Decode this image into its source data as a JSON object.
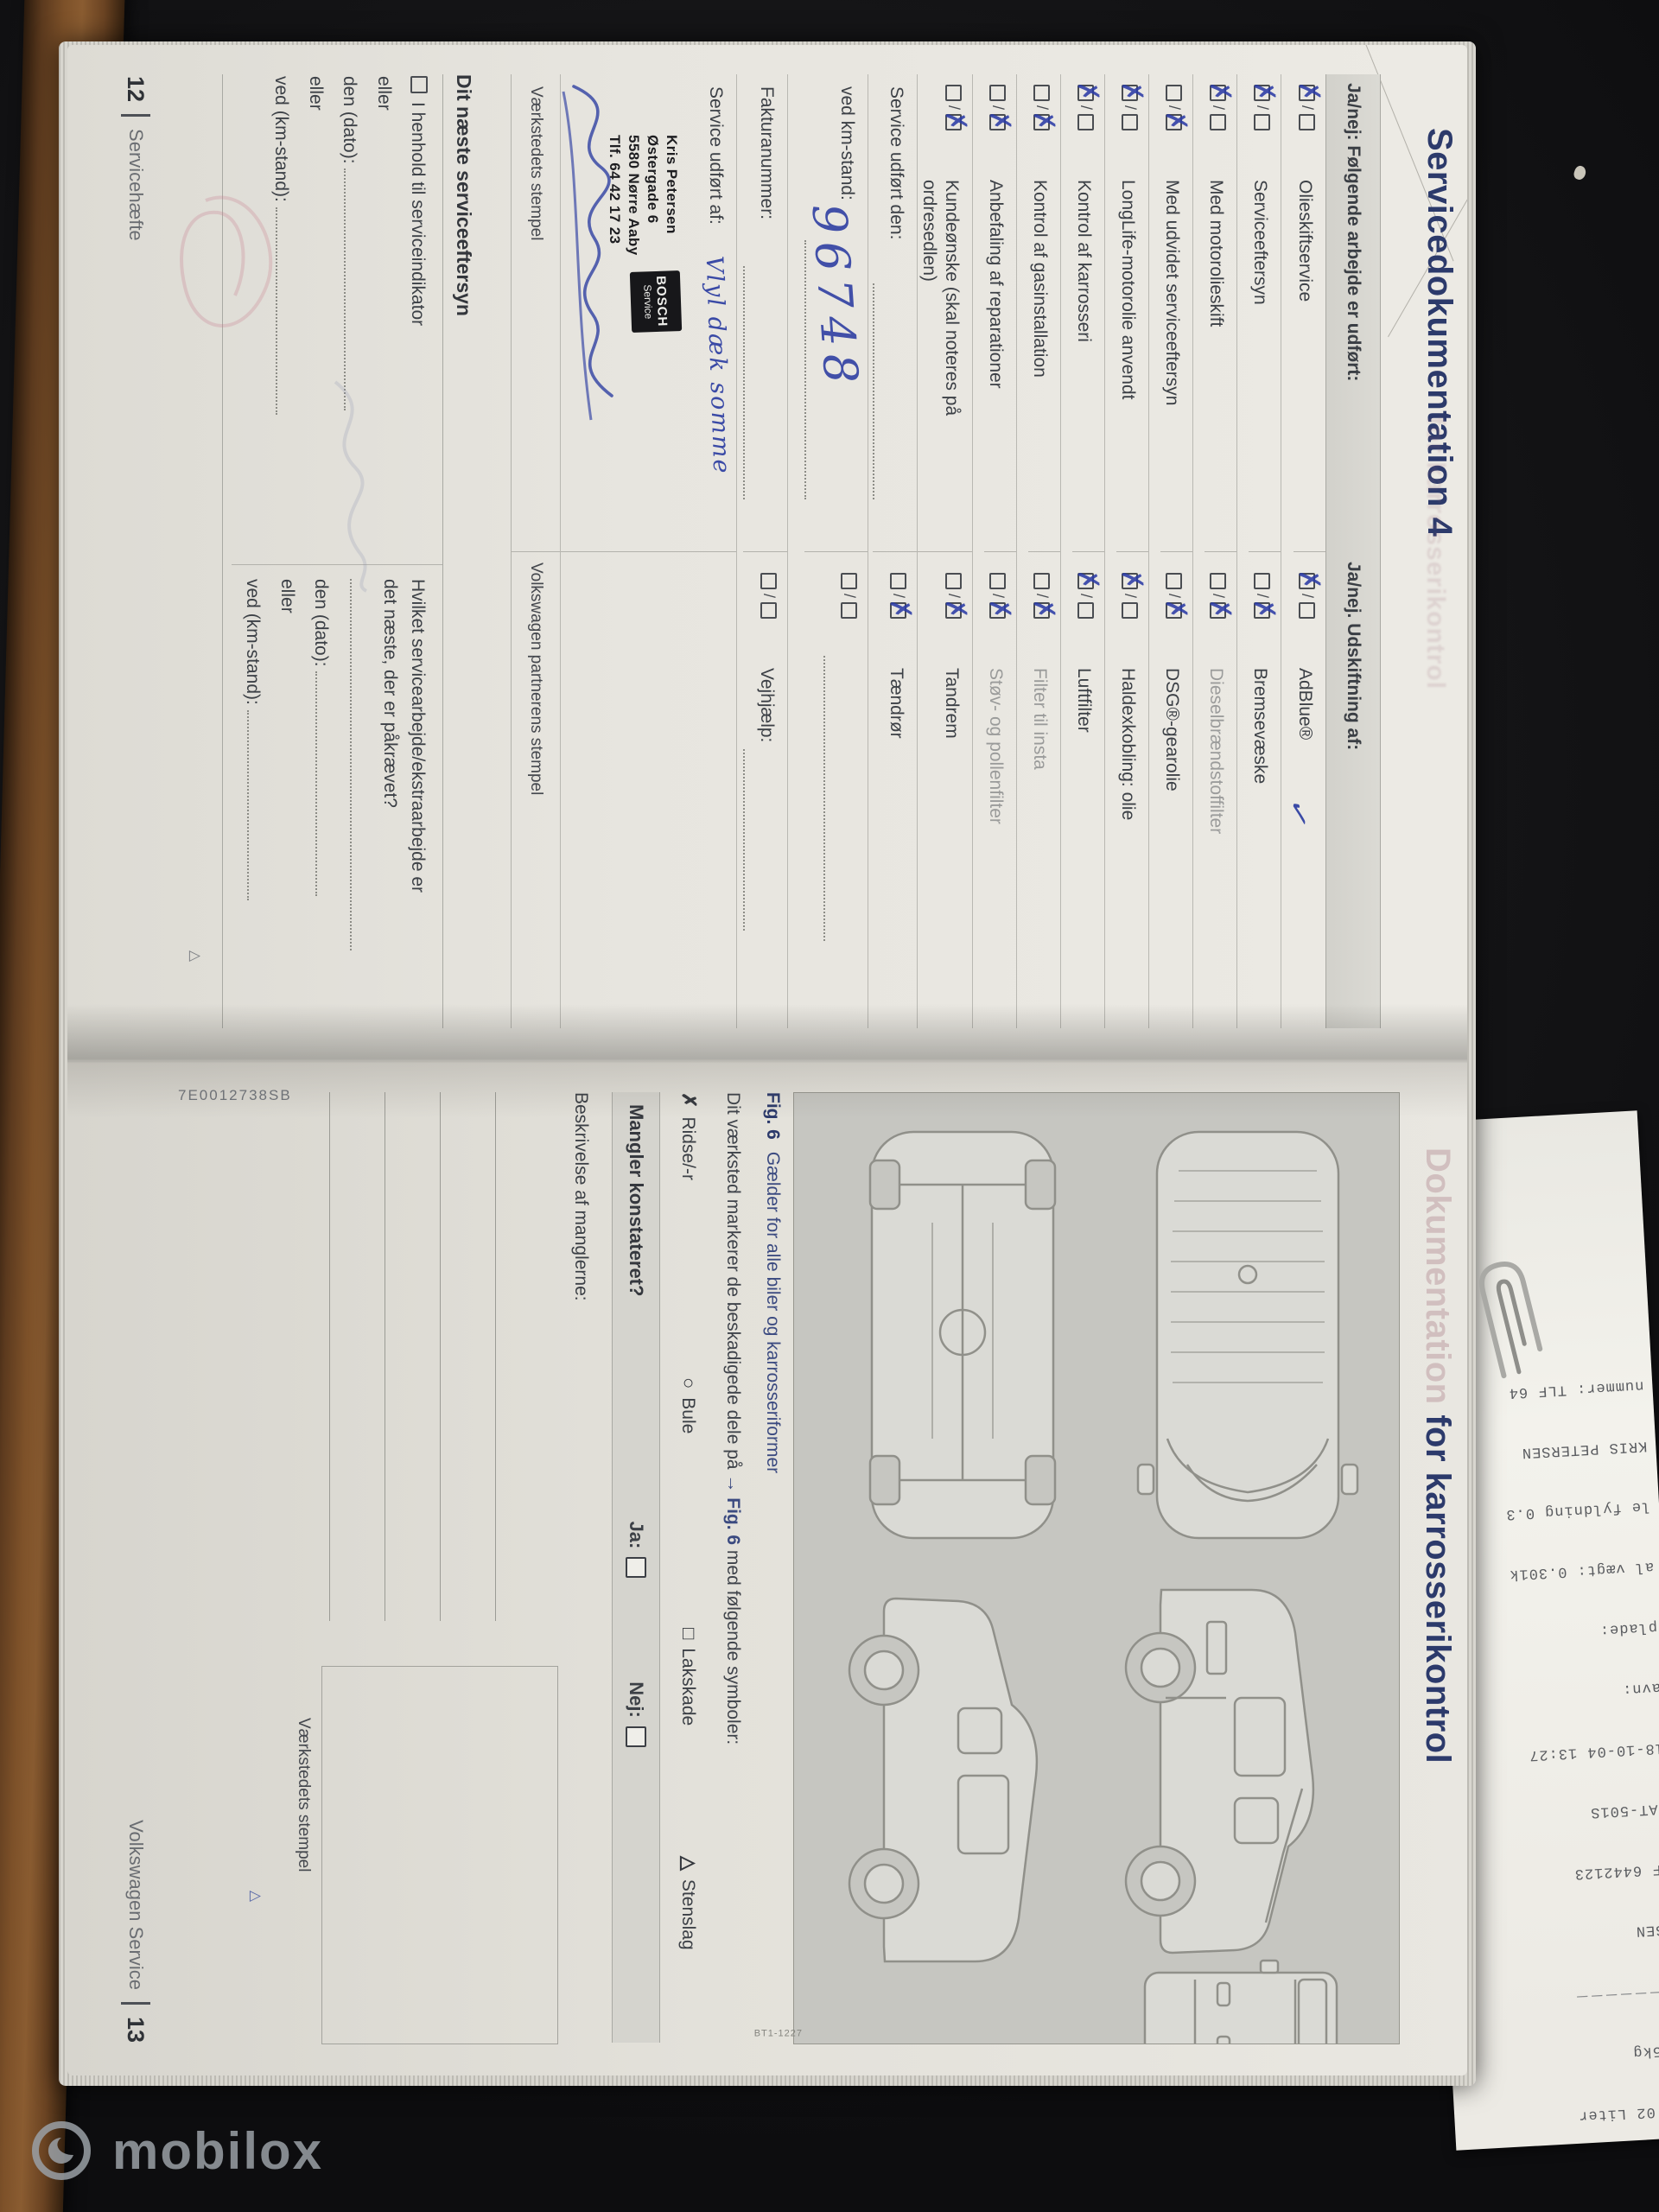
{
  "watermark": {
    "brand": "mobilox"
  },
  "book": {
    "page12": {
      "title": "Servicedokumentation 4",
      "ghost_title": "for karrosserikontrol",
      "table": {
        "header_left": "Ja/nej: Følgende arbejde er udført:",
        "header_right": "Ja/nej. Udskiftning af:",
        "rows": [
          {
            "left": "Olieskiftservice",
            "l_ja": "✗",
            "l_nej": "",
            "right": "AdBlue®",
            "r_ja": "✗",
            "r_nej": ""
          },
          {
            "left": "Serviceeftersyn",
            "l_ja": "✗",
            "l_nej": "",
            "right": "Bremsevæske",
            "r_ja": "",
            "r_nej": "✗"
          },
          {
            "left": "Med motorolieskift",
            "l_ja": "✗",
            "l_nej": "",
            "right": "Dieselbrændstoffilter",
            "r_ja": "",
            "r_nej": "✗"
          },
          {
            "left": "Med udvidet serviceeftersyn",
            "l_ja": "",
            "l_nej": "✗",
            "right": "DSG®-gearolie",
            "r_ja": "",
            "r_nej": "✗"
          },
          {
            "left": "LongLife-motorolie anvendt",
            "l_ja": "✗",
            "l_nej": "",
            "right": "Haldexkobling: olie",
            "r_ja": "✗",
            "r_nej": ""
          },
          {
            "left": "Kontrol af karrosseri",
            "l_ja": "✗",
            "l_nej": "",
            "right": "Luftfilter",
            "r_ja": "✗",
            "r_nej": ""
          },
          {
            "left": "Kontrol af gasinstallation",
            "l_ja": "",
            "l_nej": "✗",
            "right": "Filter til insta",
            "r_ja": "",
            "r_nej": "✗"
          },
          {
            "left": "Anbefaling af reparationer",
            "l_ja": "",
            "l_nej": "✗",
            "right": "Støv- og pollenfilter",
            "r_ja": "",
            "r_nej": "✗"
          },
          {
            "left": "Kundeønske (skal noteres på ordresedlen)",
            "l_ja": "",
            "l_nej": "✗",
            "right": "Tandrem",
            "r_ja": "",
            "r_nej": "✗"
          }
        ],
        "service_done_label": "Service udført den:",
        "tandror_label": "Tændrør",
        "tandror_nej": "✗",
        "km_label": "ved km-stand:",
        "km_value": "96748",
        "invoice_label": "Fakturanummer:",
        "roadside_label": "Vejhjælp:",
        "done_by_label": "Service udført af:",
        "done_by_handwriting": "Vlyl dæk somme",
        "adblue_scribble": "✓",
        "stamp": {
          "line1": "Kris Petersen",
          "line2": "Østergade 6",
          "line3": "5580 Nørre Aaby",
          "line4": "Tlf. 64 42 17 23",
          "logo_top": "BOSCH",
          "logo_bottom": "Service"
        },
        "workshop_stamp_caption": "Værkstedets stempel",
        "partner_stamp_caption": "Volkswagen partnerens stempel"
      },
      "next_service": {
        "heading": "Dit næste serviceeftersyn",
        "indicator_option": "I henhold til serviceindikator",
        "or_label": "eller",
        "date_label": "den (dato):",
        "km_label": "ved (km-stand):",
        "question_line1": "Hvilket servicearbejde/ekstraarbejde er",
        "question_line2": "det næste, der er påkrævet?"
      },
      "page_number": "12",
      "page_footer_label": "Servicehæfte",
      "continue_mark": "△"
    },
    "page13": {
      "title_faded": "Dokumentation ",
      "title": "for karrosserikontrol",
      "figure": {
        "caption_fig": "Fig. 6",
        "caption_text": "Gælder for alle biler og karrosseriformer",
        "code": "BT1-1227"
      },
      "marking_note_prefix": "Dit værksted markerer de beskadigede dele på ",
      "marking_note_fig": "→ Fig. 6",
      "marking_note_suffix": " med følgende symboler:",
      "legend": [
        {
          "symbol": "✗",
          "label": "Ridse/-r"
        },
        {
          "symbol": "○",
          "label": "Bule"
        },
        {
          "symbol": "□",
          "label": "Lakskade"
        },
        {
          "symbol": "△",
          "label": "Stenslag"
        }
      ],
      "defects_question": "Mangler konstateret?",
      "yes_label": "Ja:",
      "no_label": "Nej:",
      "description_label": "Beskrivelse af manglerne:",
      "workshop_stamp_caption": "Værkstedets stempel",
      "part_number": "7E0012738SB",
      "page_footer_label": "Volkswagen Service",
      "page_number": "13",
      "continue_mark": "△"
    }
  },
  "receipt": {
    "lines": [
      "10.02 Liter",
      "725kg",
      "－－－－－－－",
      "RSEN",
      "LF 6442123",
      "CAT-501S",
      "18-10-04 13:27",
      "avn:",
      "plade:",
      "al vægt: 0.301k",
      "le fyldning 0.3",
      "KRIS PETERSEN",
      "nummer: TLF 64"
    ]
  },
  "colors": {
    "print_blue": "#2c3a6b",
    "handwriting_blue": "#3343a4",
    "paper": "#e9e7e1",
    "background": "#151517",
    "wood": "#7d5129"
  }
}
